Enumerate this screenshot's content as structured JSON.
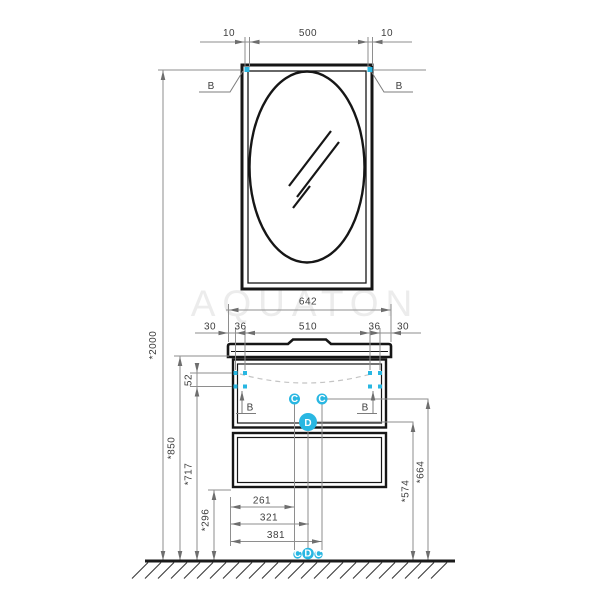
{
  "watermark": "AQUATON",
  "dimensions": {
    "mirror_top": {
      "left": "10",
      "width": "500",
      "right": "10"
    },
    "cabinet": {
      "width": "642",
      "top_row": {
        "m30l": "30",
        "m36l": "36",
        "m510": "510",
        "m36r": "36",
        "m30r": "30"
      }
    },
    "left": {
      "total_height": "*2000",
      "counter_height": "*850",
      "holes_gap": "52",
      "holes_height": "*717",
      "bottom_clearance": "*296"
    },
    "right": {
      "drain_height": "*574",
      "supply_height": "*664"
    },
    "bottom": {
      "c_left_offset": "261",
      "d_offset": "321",
      "c_right_offset": "381"
    }
  },
  "labels": {
    "bracket": "B",
    "supply": "C",
    "drain": "D"
  },
  "colors": {
    "accent_cyan": "#29b7e2",
    "outline": "#161616",
    "dimension": "#8e8e8e"
  }
}
